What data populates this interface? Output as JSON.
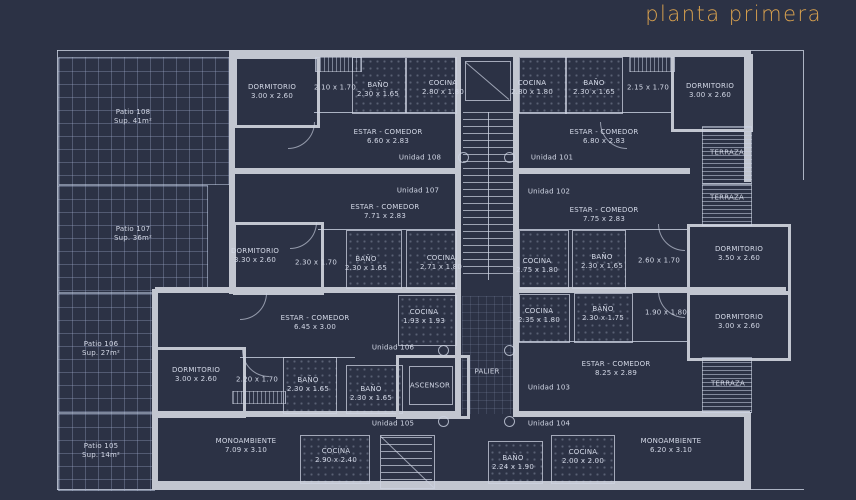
{
  "title": "planta primera",
  "colors": {
    "background": "#2c3245",
    "accent": "#daa24e",
    "wall": "#c2c6d0",
    "line": "#cdd3e2",
    "text": "#d3d8e6"
  },
  "terraza_label": "TERRAZA",
  "core": {
    "palier": "PALIER",
    "ascensor": "ASCENSOR"
  },
  "patios": [
    {
      "name": "Patio 108",
      "sup": "Sup. 41m²"
    },
    {
      "name": "Patio 107",
      "sup": "Sup. 36m²"
    },
    {
      "name": "Patio 106",
      "sup": "Sup. 27m²"
    },
    {
      "name": "Patio 105",
      "sup": "Sup. 14m²"
    }
  ],
  "units": [
    {
      "id": "108",
      "label": "Unidad 108",
      "rooms": [
        {
          "name": "DORMITORIO",
          "dims": "3.00 x 2.60"
        },
        {
          "name": "",
          "dims": "2.10 x 1.70"
        },
        {
          "name": "BAÑO",
          "dims": "2.30 x 1.65"
        },
        {
          "name": "COCINA",
          "dims": "2.80 x 1.80"
        },
        {
          "name": "ESTAR - COMEDOR",
          "dims": "6.60 x 2.83"
        }
      ]
    },
    {
      "id": "101",
      "label": "Unidad 101",
      "rooms": [
        {
          "name": "COCINA",
          "dims": "2.80 x 1.80"
        },
        {
          "name": "BAÑO",
          "dims": "2.30 x 1.65"
        },
        {
          "name": "",
          "dims": "2.15 x 1.70"
        },
        {
          "name": "DORMITORIO",
          "dims": "3.00 x 2.60"
        },
        {
          "name": "ESTAR - COMEDOR",
          "dims": "6.80 x 2.83"
        }
      ]
    },
    {
      "id": "107",
      "label": "Unidad 107",
      "rooms": [
        {
          "name": "ESTAR - COMEDOR",
          "dims": "7.71 x 2.83"
        },
        {
          "name": "DORMITORIO",
          "dims": "3.30 x 2.60"
        },
        {
          "name": "",
          "dims": "2.30 x 1.70"
        },
        {
          "name": "BAÑO",
          "dims": "2.30 x 1.65"
        },
        {
          "name": "COCINA",
          "dims": "2.71 x 1.80"
        }
      ]
    },
    {
      "id": "102",
      "label": "Unidad 102",
      "rooms": [
        {
          "name": "ESTAR - COMEDOR",
          "dims": "7.75 x 2.83"
        },
        {
          "name": "COCINA",
          "dims": "2.75 x 1.80"
        },
        {
          "name": "BAÑO",
          "dims": "2.30 x 1.65"
        },
        {
          "name": "",
          "dims": "2.60 x 1.70"
        },
        {
          "name": "DORMITORIO",
          "dims": "3.50 x 2.60"
        }
      ]
    },
    {
      "id": "106",
      "label": "Unidad 106",
      "rooms": [
        {
          "name": "ESTAR - COMEDOR",
          "dims": "6.45 x 3.00"
        },
        {
          "name": "COCINA",
          "dims": "1.93 x 1.93"
        },
        {
          "name": "DORMITORIO",
          "dims": "3.00 x 2.60"
        },
        {
          "name": "",
          "dims": "2.20 x 1.70"
        },
        {
          "name": "BAÑO",
          "dims": "2.30 x 1.65"
        },
        {
          "name": "BAÑO",
          "dims": "2.30 x 1.65"
        }
      ]
    },
    {
      "id": "103",
      "label": "Unidad 103",
      "rooms": [
        {
          "name": "COCINA",
          "dims": "2.35 x 1.80"
        },
        {
          "name": "BAÑO",
          "dims": "2.30 x 1.75"
        },
        {
          "name": "",
          "dims": "1.90 x 1.80"
        },
        {
          "name": "DORMITORIO",
          "dims": "3.00 x 2.60"
        },
        {
          "name": "ESTAR - COMEDOR",
          "dims": "8.25 x 2.89"
        }
      ]
    },
    {
      "id": "105",
      "label": "Unidad 105",
      "rooms": [
        {
          "name": "MONOAMBIENTE",
          "dims": "7.09 x 3.10"
        },
        {
          "name": "COCINA",
          "dims": "2.90 x 2.40"
        }
      ]
    },
    {
      "id": "104",
      "label": "Unidad 104",
      "rooms": [
        {
          "name": "BAÑO",
          "dims": "2.24 x 1.90"
        },
        {
          "name": "COCINA",
          "dims": "2.00 x 2.00"
        },
        {
          "name": "MONOAMBIENTE",
          "dims": "6.20 x 3.10"
        }
      ]
    }
  ]
}
